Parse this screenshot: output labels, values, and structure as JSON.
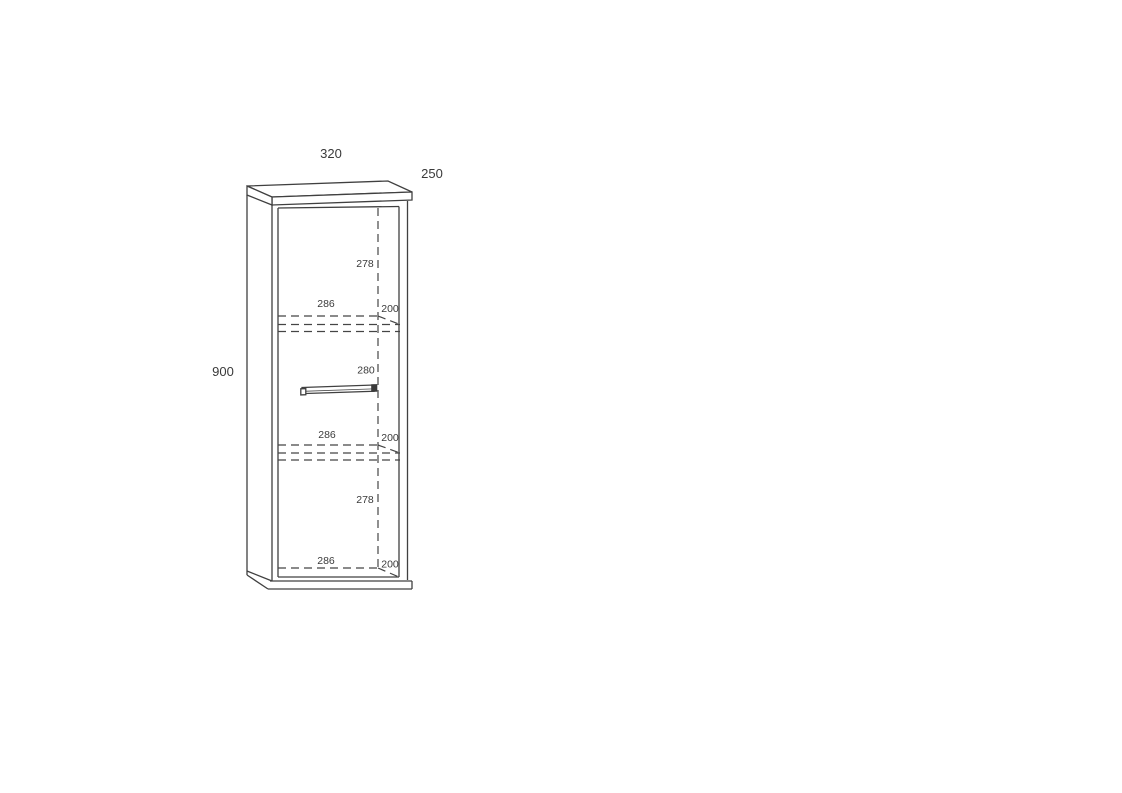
{
  "colors": {
    "background": "#ffffff",
    "line": "#404040",
    "text": "#3a3a3a"
  },
  "labels": {
    "overall_width": "320",
    "overall_depth": "250",
    "overall_height": "900",
    "top_section_height": "278",
    "shelf1_inner_width": "286",
    "shelf1_depth": "200",
    "middle_section_height": "280",
    "shelf2_inner_width": "286",
    "shelf2_depth": "200",
    "bottom_section_height": "278",
    "bottom_inner_width": "286",
    "bottom_depth": "200"
  }
}
